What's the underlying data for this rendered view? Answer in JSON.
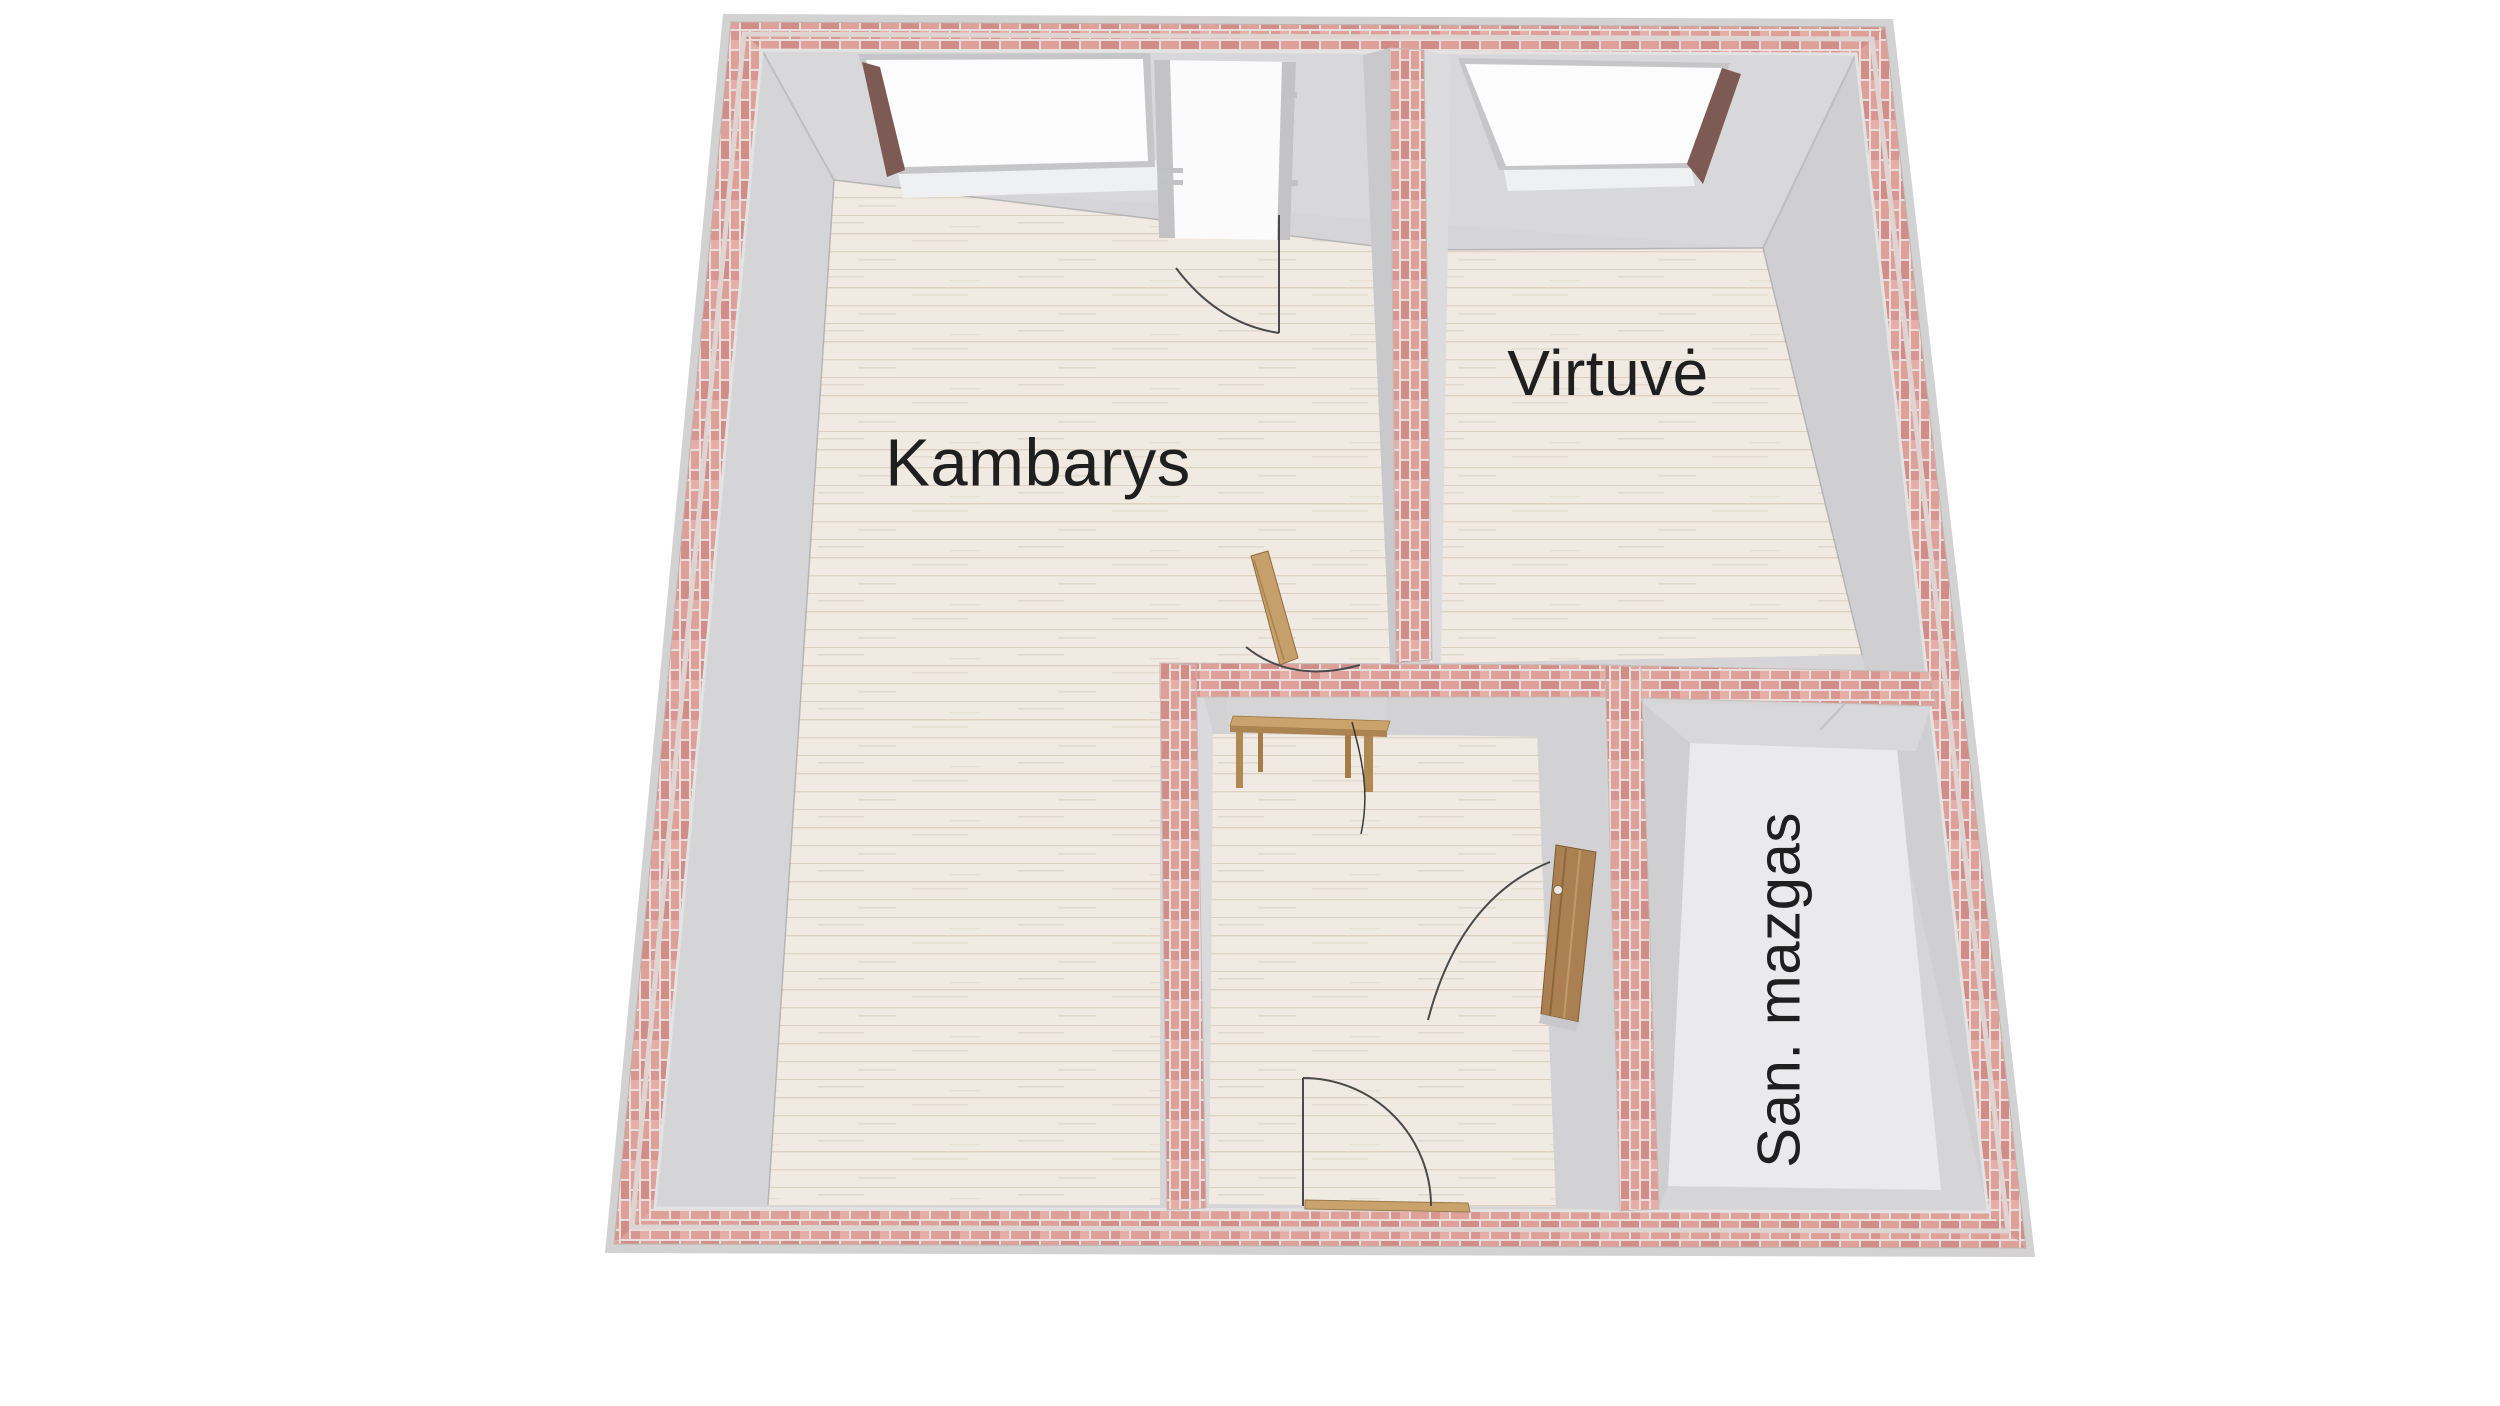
{
  "floor_plan": {
    "rooms": [
      {
        "id": "kambarys",
        "label": "Kambarys"
      },
      {
        "id": "virtuve",
        "label": "Virtuvė"
      },
      {
        "id": "san-mazgas",
        "label": "San. mazgas"
      }
    ],
    "colors": {
      "background": "#ffffff",
      "brick": "#dda19a",
      "brick_light": "#e5aea6",
      "brick_dark": "#d18e88",
      "mortar": "#e9dedb",
      "outer_rim": "#d2d2d2",
      "wall_face": "#d5d5d7",
      "wall_face_dark": "#cbcbcd",
      "wood_floor": "#f0eae2",
      "wood_grain": "#a78460",
      "bath_floor": "#eaeaec",
      "window_pane": "#fcfcfd",
      "window_frame": "#c6c6c8",
      "window_reveal": "#7e5a54",
      "door_wood": "#aa8052",
      "door_wood_light": "#c5a06b",
      "swing_line": "#4a4a4a",
      "label_text": "#1f1f1f"
    }
  }
}
